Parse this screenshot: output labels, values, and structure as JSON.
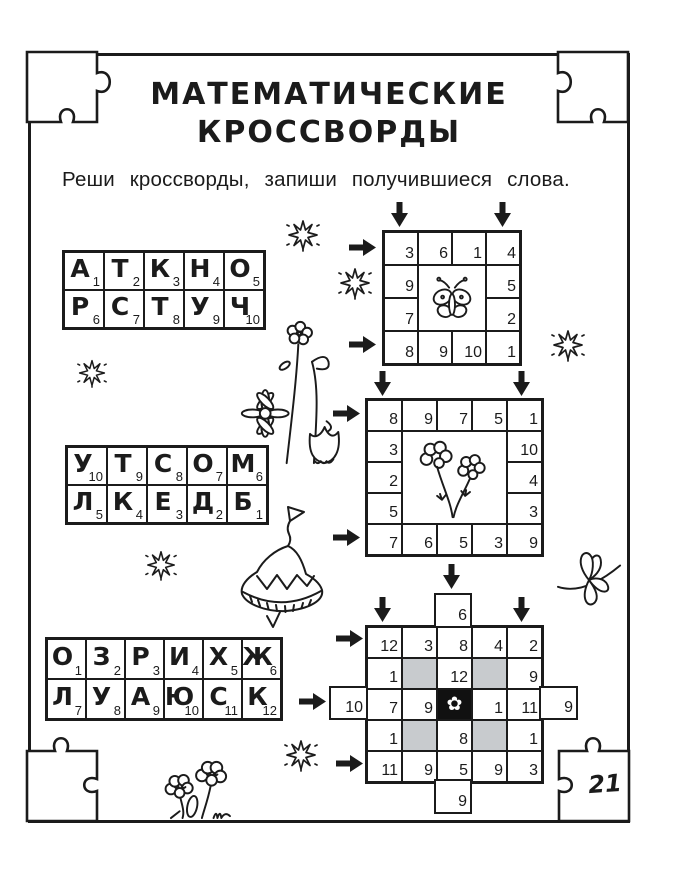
{
  "title": {
    "line1": "МАТЕМАТИЧЕСКИЕ",
    "line2": "КРОССВОРДЫ"
  },
  "instruction": "Реши кроссворды, запиши получившиеся слова.",
  "page_number": "21",
  "colors": {
    "ink": "#1b1b1b",
    "gray_cell": "#c8cbce",
    "black_cell": "#111111"
  },
  "icons": {
    "center_flower": "✿"
  },
  "tables": {
    "t1": {
      "letters": [
        "А",
        "Т",
        "К",
        "Н",
        "О",
        "Р",
        "С",
        "Т",
        "У",
        "Ч"
      ],
      "nums": [
        "1",
        "2",
        "3",
        "4",
        "5",
        "6",
        "7",
        "8",
        "9",
        "10"
      ]
    },
    "t2": {
      "letters": [
        "У",
        "Т",
        "С",
        "О",
        "М",
        "Л",
        "К",
        "Е",
        "Д",
        "Б"
      ],
      "nums": [
        "10",
        "9",
        "8",
        "7",
        "6",
        "5",
        "4",
        "3",
        "2",
        "1"
      ]
    },
    "t3": {
      "letters": [
        "О",
        "З",
        "Р",
        "И",
        "Х",
        "Ж",
        "Л",
        "У",
        "А",
        "Ю",
        "С",
        "К"
      ],
      "nums": [
        "1",
        "2",
        "3",
        "4",
        "5",
        "6",
        "7",
        "8",
        "9",
        "10",
        "11",
        "12"
      ]
    }
  },
  "grids": {
    "g1": {
      "cells": [
        "3",
        "6",
        "1",
        "4",
        "9",
        "5",
        "7",
        "2",
        "8",
        "9",
        "10",
        "1"
      ]
    },
    "g2": {
      "cells": [
        "8",
        "9",
        "7",
        "5",
        "1",
        "3",
        "10",
        "2",
        "4",
        "5",
        "3",
        "7",
        "6",
        "5",
        "3",
        "9"
      ]
    },
    "g3": {
      "cells": [
        "12",
        "3",
        "8",
        "4",
        "2",
        "1",
        "12",
        "9",
        "7",
        "9",
        "1",
        "11",
        "1",
        "8",
        "1",
        "11",
        "9",
        "5",
        "9",
        "3"
      ],
      "ext": {
        "top": "6",
        "left": "10",
        "right": "9",
        "bottom": "9"
      }
    }
  }
}
